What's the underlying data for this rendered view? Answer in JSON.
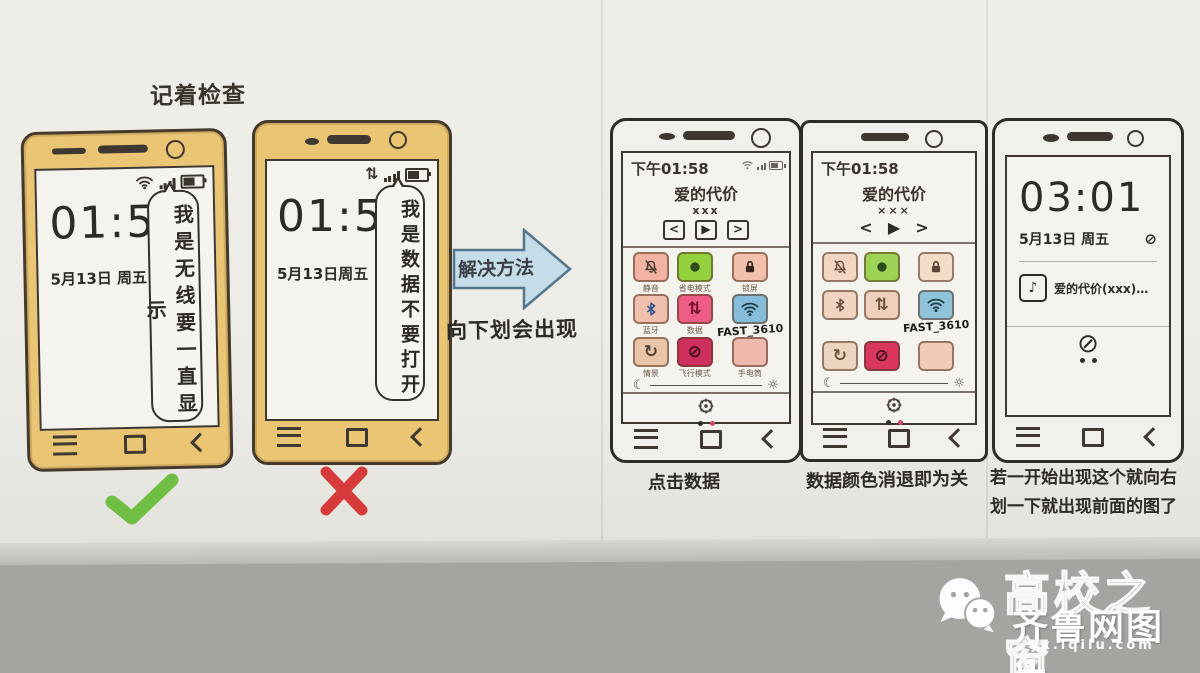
{
  "labels": {
    "top_note": "记着检查",
    "arrow": "解决方法",
    "arrow_sub": "向下划会出现"
  },
  "icons": {
    "data_arrows": "⇅",
    "moon": "☾",
    "sun": "☼",
    "block": "⊘",
    "note": "♪",
    "ellipsis_dash": "…"
  },
  "phone1": {
    "clock": "01:58",
    "date": "5月13日 周五",
    "callout": "我是无线要一直显示"
  },
  "phone2": {
    "clock": "01:58",
    "date": "5月13日周五",
    "callout": "我是数据不要打开"
  },
  "phone3": {
    "time": "下午01:58",
    "song": "爱的代价",
    "song_sub": "xxx",
    "media": {
      "prev": "<",
      "play": "▶",
      "next": ">"
    },
    "caption": "点击数据",
    "grid": [
      {
        "icon": "bell-slash-icon",
        "label": "静音",
        "bg": "#f2b3a2",
        "fg": "#4a3a30"
      },
      {
        "icon": "blob-icon",
        "label": "省电模式",
        "bg": "#93d13f",
        "fg": "#2c4a1c"
      },
      {
        "icon": "lock-icon",
        "label": "锁屏",
        "bg": "#f4c0ae",
        "fg": "#35261d"
      },
      {
        "icon": "bluetooth-icon",
        "label": "蓝牙",
        "bg": "#efc0ad",
        "fg": "#2d4f92"
      },
      {
        "icon": "data-arrows-icon",
        "label": "数据",
        "bg": "#ef5c86",
        "fg": "#76102f"
      },
      {
        "icon": "wifi-icon",
        "label": "",
        "sub": "FAST_3610",
        "bg": "#87bdd8",
        "fg": "#1d3a47"
      },
      {
        "icon": "rotate-icon",
        "label": "情景",
        "bg": "#eac5a8",
        "fg": "#51402f"
      },
      {
        "icon": "block-icon",
        "label": "飞行模式",
        "bg": "#cf2f5e",
        "fg": "#3d0a1c"
      },
      {
        "icon": "blank-icon",
        "label": "手电筒",
        "bg": "#f0b9ad",
        "fg": "#6b5a4a"
      }
    ]
  },
  "phone4": {
    "time": "下午01:58",
    "song": "爱的代价",
    "song_sub": "×××",
    "media": {
      "prev": "<",
      "play": "▶",
      "next": ">"
    },
    "caption": "数据颜色消退即为关",
    "grid": [
      {
        "icon": "bell-slash-icon",
        "bg": "#f2d6c3",
        "fg": "#6b5340"
      },
      {
        "icon": "blob-icon",
        "bg": "#9ed455",
        "fg": "#2c4a1c"
      },
      {
        "icon": "lock-icon",
        "bg": "#f4dcc6",
        "fg": "#5c4634"
      },
      {
        "icon": "bluetooth-icon",
        "bg": "#f1d4c1",
        "fg": "#6b5340"
      },
      {
        "icon": "data-arrows-icon",
        "bg": "#f0d0bd",
        "fg": "#6b5340"
      },
      {
        "icon": "wifi-icon",
        "sub": "FAST_3610",
        "bg": "#8fc3da",
        "fg": "#1d3a47"
      },
      {
        "icon": "rotate-icon",
        "bg": "#eed5bf",
        "fg": "#6b5340"
      },
      {
        "icon": "block-icon",
        "bg": "#d8365f",
        "fg": "#42091d"
      },
      {
        "icon": "blank-icon",
        "bg": "#f2cbb8",
        "fg": "#6b5340"
      }
    ]
  },
  "phone5": {
    "clock": "03:01",
    "date": "5月13日 周五",
    "notification": "爱的代价(xxx)…",
    "caption_line1": "若一开始出现这个就向右",
    "caption_line2": "划一下就出现前面的图了"
  },
  "watermark": {
    "title": "高校之窗",
    "brand": "齐鲁网图片",
    "url": "yx.iqilu.com"
  },
  "colors": {
    "backdrop": "#a6a4a0",
    "phone_gold": "#eac573",
    "phone_border": "#44392a",
    "check_green": "#6fbf44",
    "cross_red": "#d63a3a",
    "arrow_fill": "#c5dde9",
    "arrow_stroke": "#53768c",
    "dot_black": "#2e2e2e",
    "dot_pink": "#d04a6e"
  }
}
